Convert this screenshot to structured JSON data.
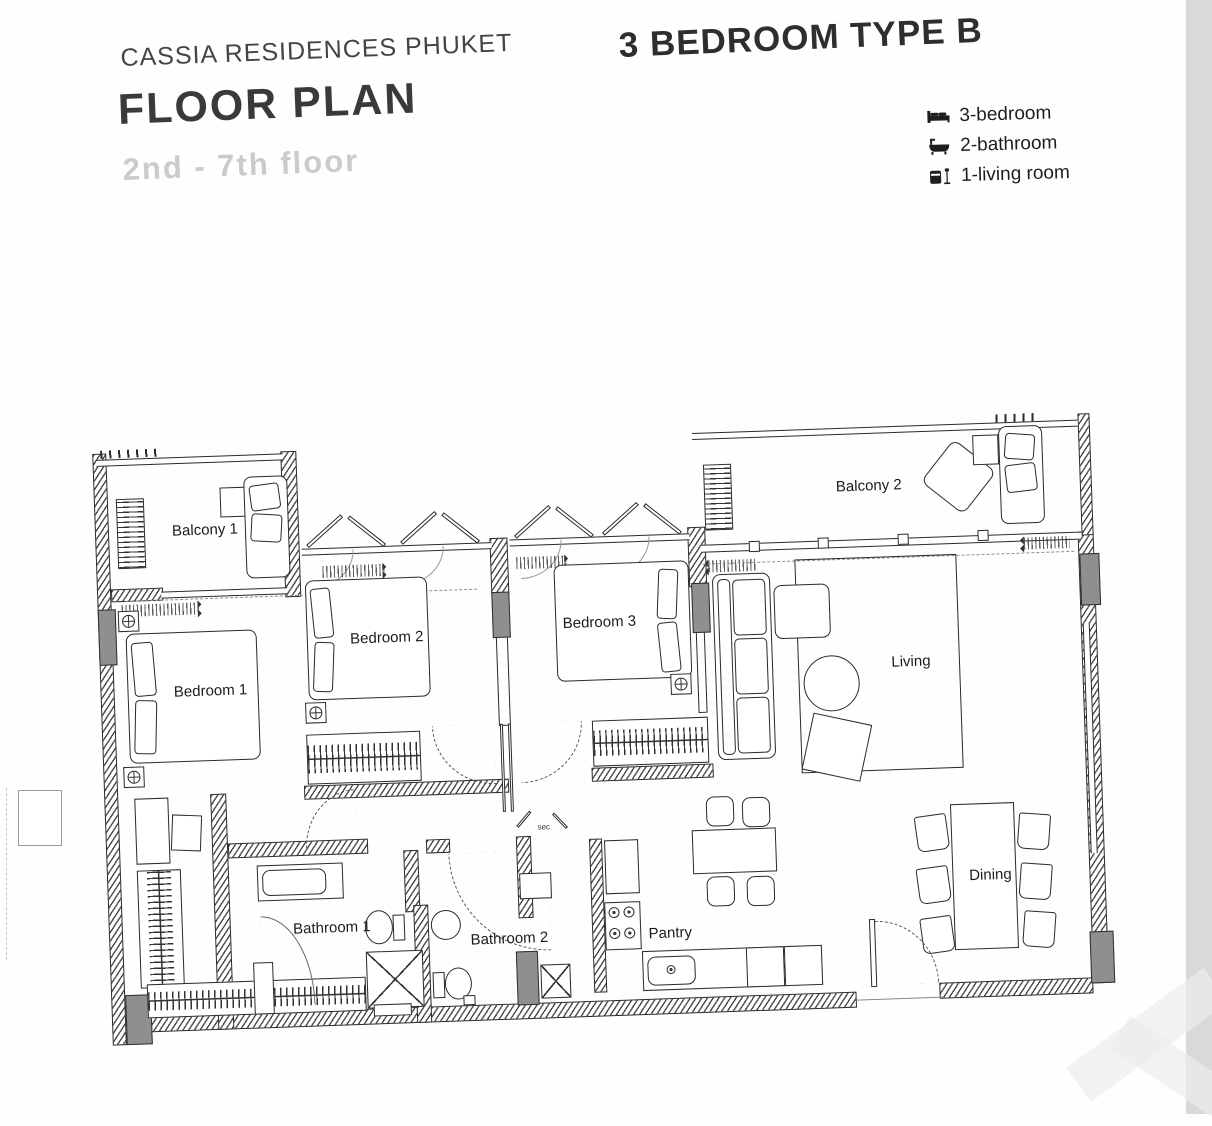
{
  "header": {
    "project": "CASSIA RESIDENCES PHUKET",
    "title": "FLOOR PLAN",
    "floors": "2nd - 7th floor"
  },
  "unit": {
    "title": "3 BEDROOM TYPE B"
  },
  "legend": {
    "items": [
      {
        "icon": "bed-icon",
        "label": "3-bedroom"
      },
      {
        "icon": "bathtub-icon",
        "label": "2-bathroom"
      },
      {
        "icon": "armchair-icon",
        "label": "1-living room"
      }
    ]
  },
  "plan": {
    "rooms": [
      {
        "label": "Balcony 1"
      },
      {
        "label": "Balcony 2"
      },
      {
        "label": "Bedroom 1"
      },
      {
        "label": "Bedroom 2"
      },
      {
        "label": "Bedroom 3"
      },
      {
        "label": "Living"
      },
      {
        "label": "Bathroom 1"
      },
      {
        "label": "Bathroom 2"
      },
      {
        "label": "Pantry"
      },
      {
        "label": "Dining"
      }
    ],
    "annotations": {
      "shaft_note": "sec"
    }
  },
  "colors": {
    "line": "#2a2a2a",
    "column_gray": "#8f8f8f",
    "scan_band": "#d9d9d9",
    "muted_text": "#cbcbcb"
  }
}
